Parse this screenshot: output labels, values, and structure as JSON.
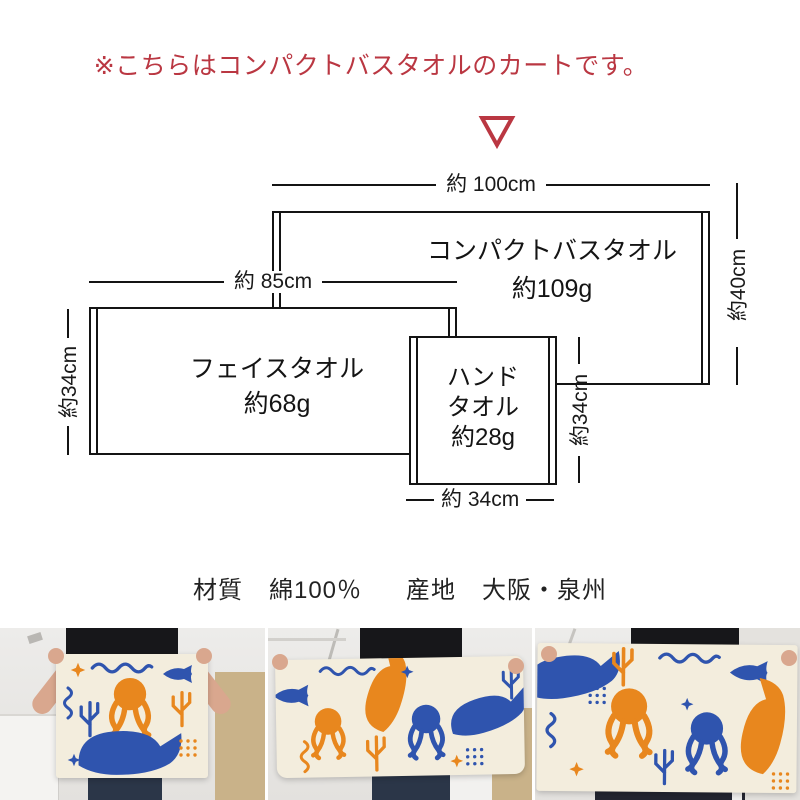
{
  "notice": {
    "text": "※こちらはコンパクトバスタオルのカートです。"
  },
  "diagram": {
    "compact": {
      "name": "コンパクトバスタオル",
      "weight": "約109g",
      "width": "約 100cm",
      "height": "約40cm"
    },
    "face": {
      "name": "フェイスタオル",
      "weight": "約68g",
      "width": "約 85cm",
      "height": "約34cm"
    },
    "hand": {
      "name_line1": "ハンド",
      "name_line2": "タオル",
      "weight": "約28g",
      "width": "約 34cm",
      "height": "約34cm"
    }
  },
  "specs": {
    "material_label": "材質",
    "material_value": "綿100％",
    "origin_label": "産地",
    "origin_value": "大阪・泉州"
  },
  "photos": [
    {
      "name": "hand-towel-held-photo"
    },
    {
      "name": "face-towel-held-photo"
    },
    {
      "name": "compact-bath-towel-held-photo"
    }
  ],
  "colors": {
    "accent_red": "#ba3742",
    "diagram_line": "#141414",
    "towel_orange": "#e8871e",
    "towel_blue": "#2f54ae",
    "towel_base": "#f3eddd"
  }
}
